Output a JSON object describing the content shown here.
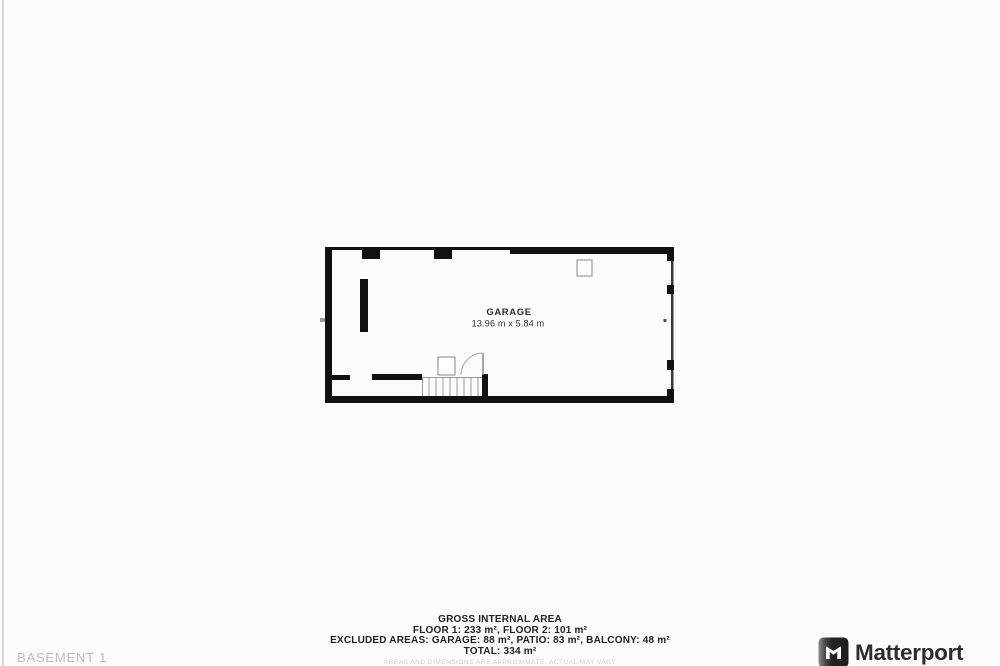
{
  "plan": {
    "room_label": "GARAGE",
    "room_dimensions": "13.96 m x 5.84 m"
  },
  "area_summary": {
    "title": "GROSS INTERNAL AREA",
    "floors_line": "FLOOR 1: 233 m², FLOOR 2: 101 m²",
    "excluded_line": "EXCLUDED AREAS: GARAGE: 88 m², PATIO: 83 m², BALCONY: 48 m²",
    "total_line": "TOTAL: 334 m²",
    "disclaimer": "AREAS AND DIMENSIONS ARE APPROXIMATE, ACTUAL MAY VARY"
  },
  "footer": {
    "floor_label": "BASEMENT 1",
    "brand_name": "Matterport"
  },
  "colors": {
    "wall": "#111111",
    "plan_text": "#2d2d2d",
    "summary_text": "#1f1f1f",
    "muted_label": "#bcbcbc",
    "brand_text": "#2d2d2d",
    "background": "#fcfcfc"
  }
}
